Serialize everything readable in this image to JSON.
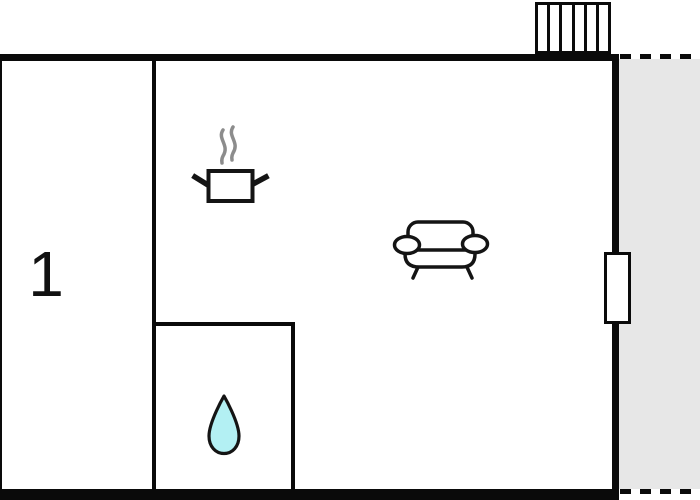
{
  "floorplan": {
    "rooms": [
      {
        "id": "room-1",
        "label": "1"
      }
    ],
    "colors": {
      "wall": "#0a0a0a",
      "terrace_fill": "#e7e7e7",
      "water_drop_fill": "#b3f0f3",
      "steam": "#8c8c8c",
      "icon_stroke": "#141414",
      "background": "#ffffff"
    },
    "radiator": {
      "cells": 6
    },
    "icons": [
      {
        "name": "radiator-icon"
      },
      {
        "name": "cooking-pot-icon"
      },
      {
        "name": "steam-icon"
      },
      {
        "name": "sofa-icon"
      },
      {
        "name": "water-drop-icon"
      },
      {
        "name": "window-marker"
      }
    ]
  }
}
